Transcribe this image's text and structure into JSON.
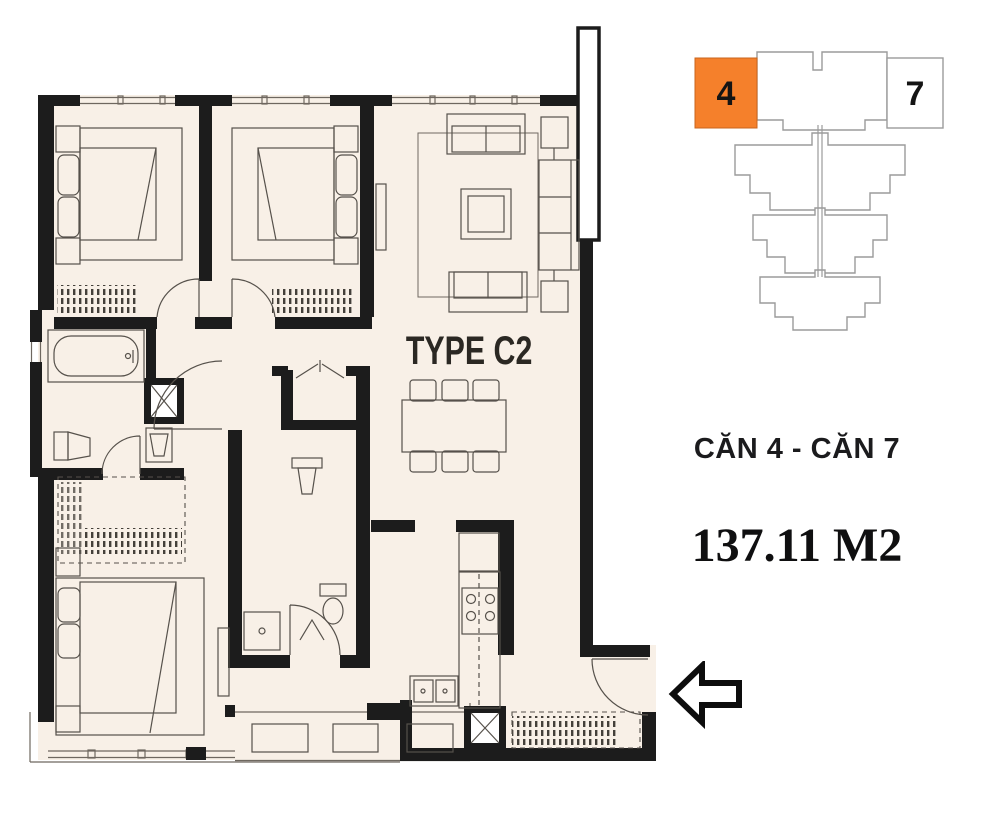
{
  "plan": {
    "type_label": "TYPE C2"
  },
  "details": {
    "units_label": "CĂN 4 - CĂN 7",
    "area_label": "137.11 M2"
  },
  "keyplan": {
    "units": [
      {
        "number": "4",
        "highlighted": true
      },
      {
        "number": "7",
        "highlighted": false
      }
    ],
    "highlight_color": "#F5802B",
    "outline_color": "#9B9B9B"
  },
  "colors": {
    "wall": "#1C1C1C",
    "floor": "#F8F0E7",
    "furniture_line": "#56514B",
    "background": "#FFFFFF",
    "text_dark": "#1B1B1D"
  },
  "icons": {
    "entry_arrow": "arrow-left"
  }
}
